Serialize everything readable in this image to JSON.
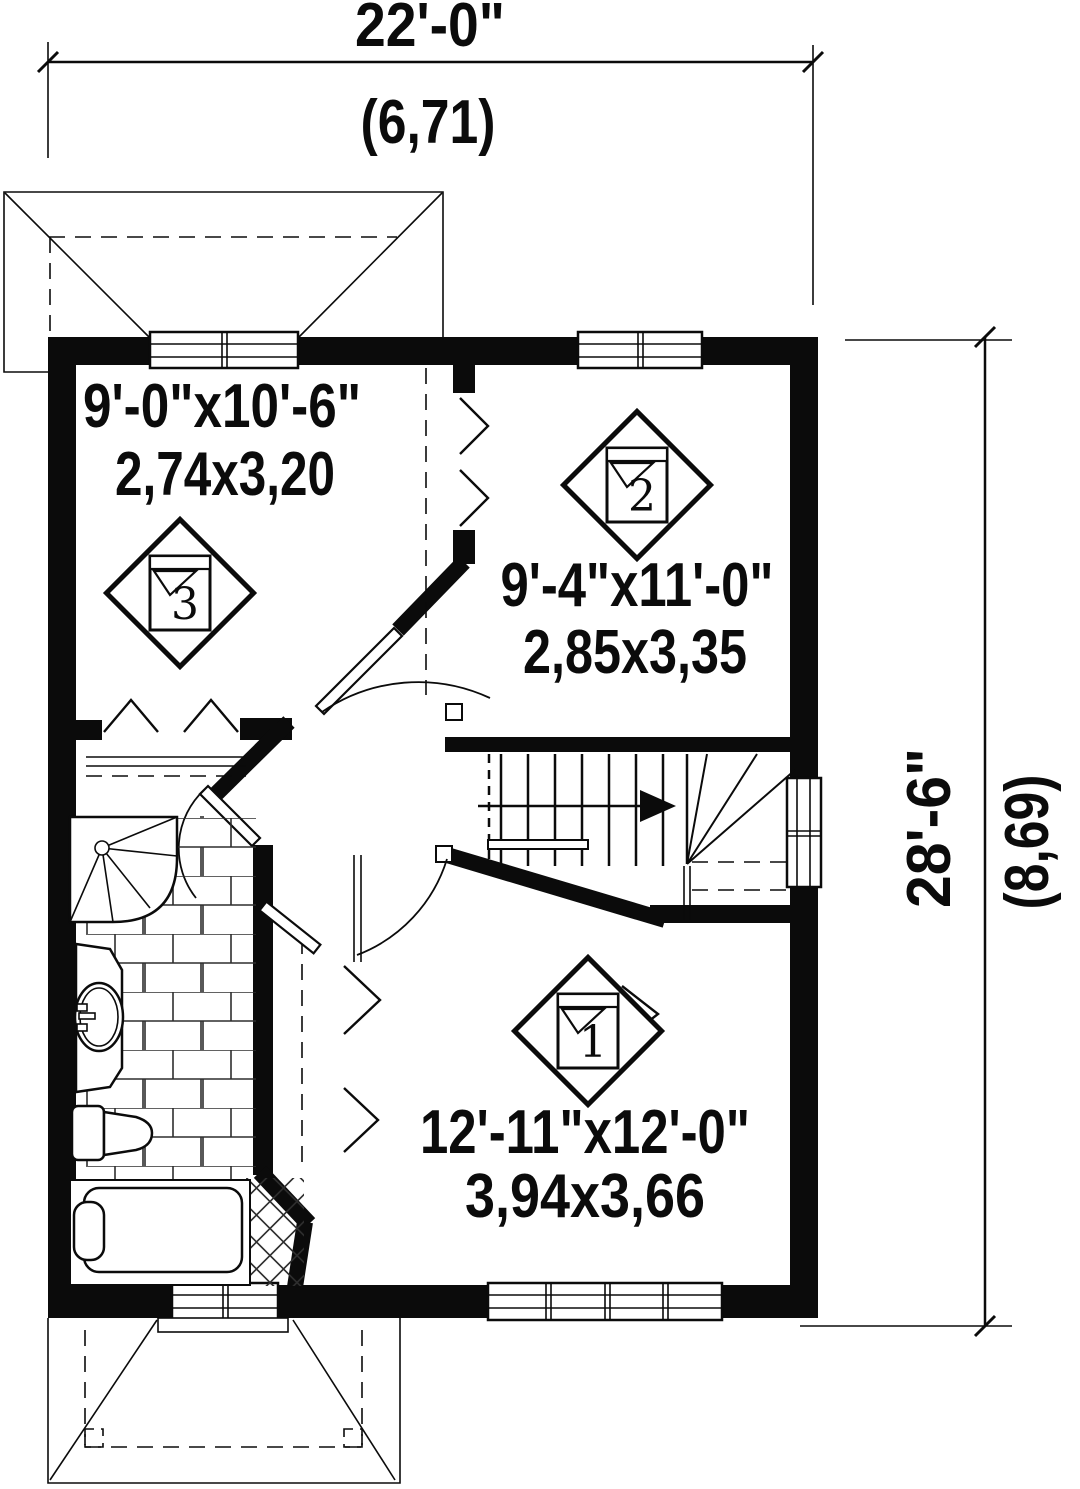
{
  "colors": {
    "ink": "#0b0b0b",
    "paper": "#ffffff",
    "tile_line": "#2e2e2e"
  },
  "plan": {
    "type": "floor-plan",
    "floor": "upper level"
  },
  "dimensions": {
    "width": {
      "imperial": "22'-0\"",
      "metric": "(6,71)"
    },
    "height": {
      "imperial": "28'-6\"",
      "metric": "(8,69)"
    }
  },
  "rooms": [
    {
      "number": "1",
      "imperial": "12'-11\"x12'-0\"",
      "metric": "3,94x3,66"
    },
    {
      "number": "2",
      "imperial": "9'-4\"x11'-0\"",
      "metric": "2,85x3,35"
    },
    {
      "number": "3",
      "imperial": "9'-0\"x10'-6\"",
      "metric": "2,74x3,20"
    }
  ]
}
